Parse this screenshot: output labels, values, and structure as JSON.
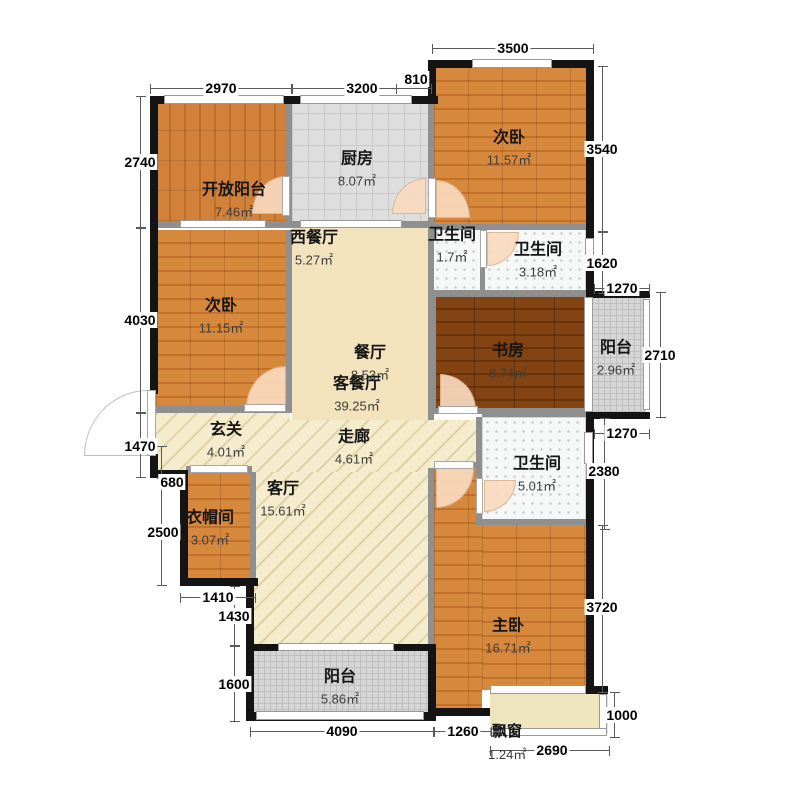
{
  "plan": {
    "rooms": [
      {
        "label": "开放阳台",
        "area": "7.46㎡"
      },
      {
        "label": "厨房",
        "area": "8.07㎡"
      },
      {
        "label": "次卧",
        "area": "11.57㎡"
      },
      {
        "label": "西餐厅",
        "area": "5.27㎡"
      },
      {
        "label": "卫生间",
        "area": "1.7㎡"
      },
      {
        "label": "卫生间",
        "area": "3.18㎡"
      },
      {
        "label": "次卧",
        "area": "11.15㎡"
      },
      {
        "label": "餐厅",
        "area": "8.53㎡"
      },
      {
        "label": "客餐厅",
        "area": "39.25㎡"
      },
      {
        "label": "书房",
        "area": "8.74㎡"
      },
      {
        "label": "阳台",
        "area": "2.96㎡"
      },
      {
        "label": "玄关",
        "area": "4.01㎡"
      },
      {
        "label": "走廊",
        "area": "4.61㎡"
      },
      {
        "label": "卫生间",
        "area": "5.01㎡"
      },
      {
        "label": "衣帽间",
        "area": "3.07㎡"
      },
      {
        "label": "客厅",
        "area": "15.61㎡"
      },
      {
        "label": "主卧",
        "area": "16.71㎡"
      },
      {
        "label": "阳台",
        "area": "5.86㎡"
      },
      {
        "label": "飘窗",
        "area": "1.24㎡"
      }
    ],
    "dims": {
      "top": [
        "2970",
        "3200",
        "810",
        "3500"
      ],
      "left": [
        "2740",
        "4030",
        "1470",
        "680",
        "2500",
        "1410",
        "1430",
        "1600"
      ],
      "right": [
        "3540",
        "1620",
        "1270",
        "2710",
        "1270",
        "2380",
        "3720",
        "1000"
      ],
      "bottom": [
        "4090",
        "1260",
        "2690"
      ]
    },
    "colors": {
      "wood": "#cd7d33",
      "wood_dark": "#7c3c10",
      "cream": "#f2e3bd",
      "hatch_floor": "#f5ebcd",
      "kitchen_tile": "#dedede",
      "balcony_tile": "#d6d6d6",
      "bath_tile": "#f5f8f7",
      "outer_wall": "#141414",
      "inner_wall": "#8f8f8f",
      "door_arc": "#f7d9be"
    }
  }
}
